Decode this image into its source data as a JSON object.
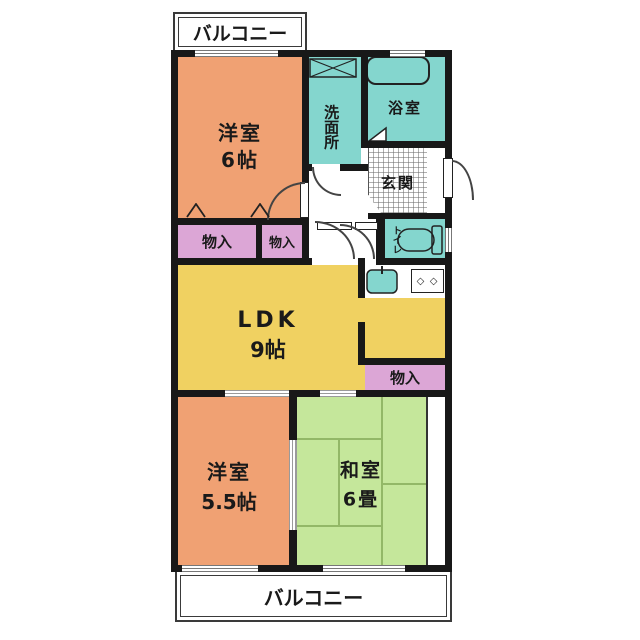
{
  "plan": {
    "balcony_top_label": "バルコニー",
    "balcony_bottom_label": "バルコニー",
    "rooms": {
      "western1_name": "洋室",
      "western1_size": "6帖",
      "washroom_name": "洗面所",
      "bath_name": "浴室",
      "entrance_name": "玄関",
      "toilet_name": "トイレ",
      "storage1_label": "物入",
      "storage2_label": "物入",
      "storage3_label": "物入",
      "ldk_name": "LDK",
      "ldk_size": "9帖",
      "western2_name": "洋室",
      "western2_size": "5.5帖",
      "japanese_name": "和室",
      "japanese_size": "6畳"
    },
    "icons": {
      "stove_burners": "◇ ◇"
    },
    "colors": {
      "western_room": "#F0A173",
      "wet_area": "#84D6CE",
      "ldk": "#F0D161",
      "storage": "#DCA6D6",
      "tatami_room": "#C5E79B",
      "wall": "#181818"
    }
  }
}
